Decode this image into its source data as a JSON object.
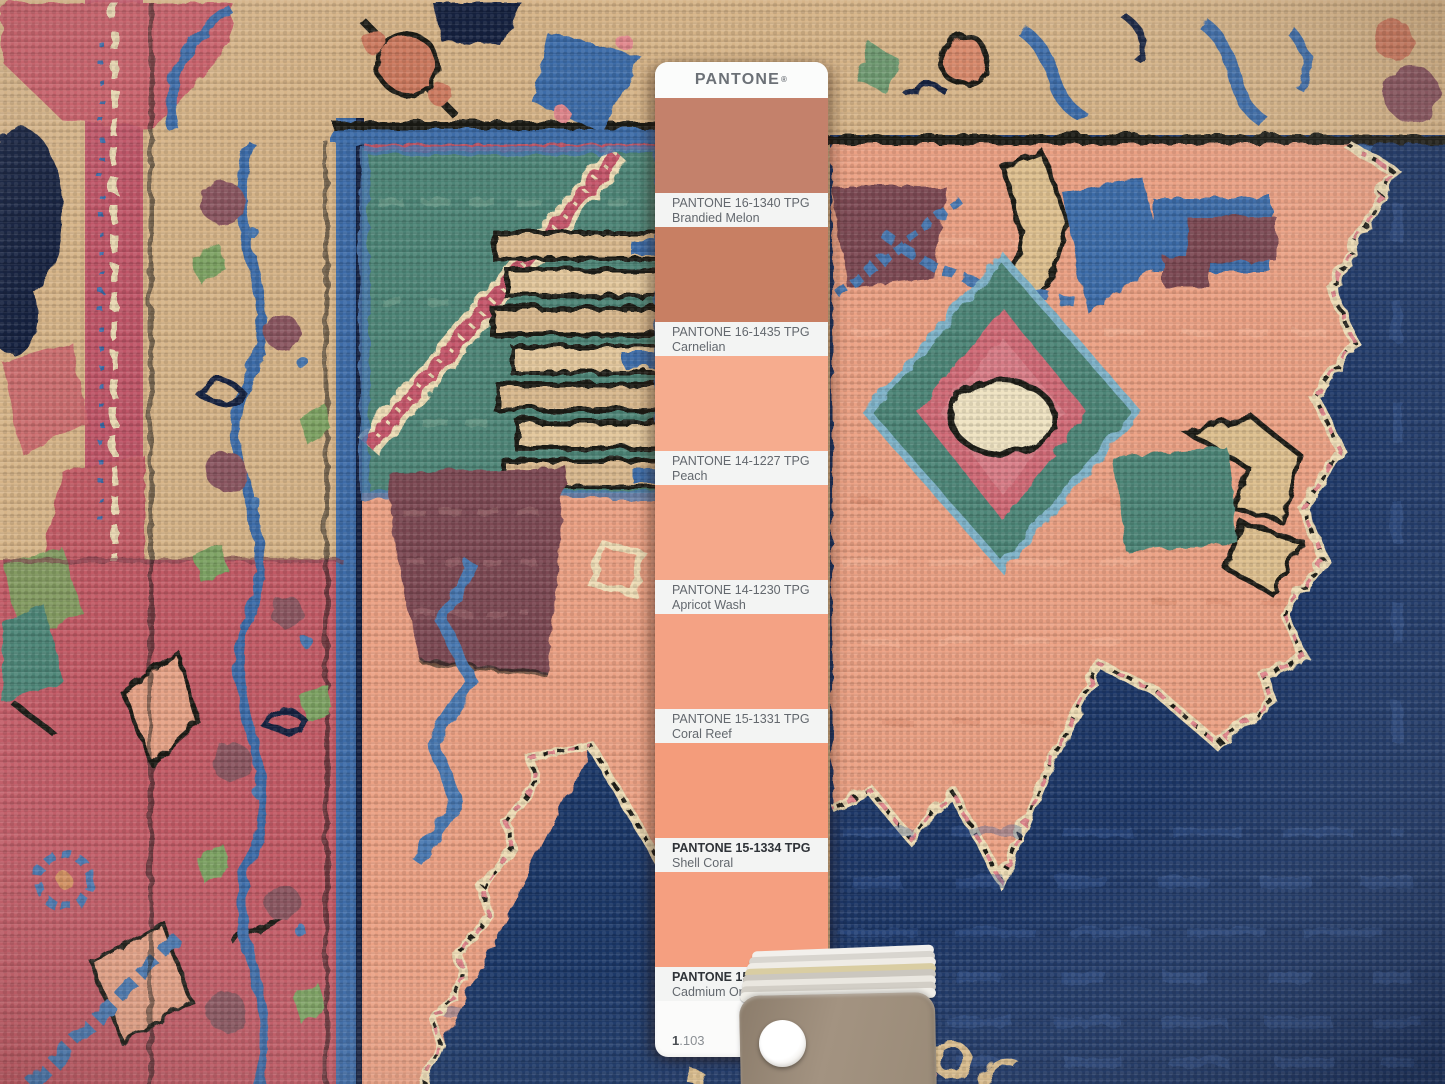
{
  "pantone": {
    "brand": "PANTONE",
    "registered_mark": "®",
    "chips": [
      {
        "code": "PANTONE 16-1340 TPG",
        "name": "Brandied Melon",
        "color": "#c4816b"
      },
      {
        "code": "PANTONE 16-1435 TPG",
        "name": "Carnelian",
        "color": "#c87f63"
      },
      {
        "code": "PANTONE 14-1227 TPG",
        "name": "Peach",
        "color": "#f6ac8e"
      },
      {
        "code": "PANTONE 14-1230 TPG",
        "name": "Apricot Wash",
        "color": "#f5a88a"
      },
      {
        "code": "PANTONE 15-1331 TPG",
        "name": "Coral Reef",
        "color": "#f4a284"
      },
      {
        "code": "PANTONE 15-1334 TPG",
        "name": "Shell Coral",
        "color": "#f49c7b"
      },
      {
        "code": "PANTONE 15-1340 TPG",
        "name": "Cadmium Orange",
        "color": "#f59f80"
      }
    ],
    "page_prefix": "1",
    "page_suffix": ".103"
  },
  "photo": {
    "rug_palette": {
      "tan_field": "#d6b488",
      "tan_light": "#e3c79c",
      "navy_field": "#1d3767",
      "navy_dark": "#14203f",
      "blue_motif": "#3e6ca8",
      "teal_field": "#4e8577",
      "salmon_medallion": "#eba184",
      "rose_field": "#c25b66",
      "red_band": "#bf5668",
      "maroon_motif": "#7c4a52",
      "cream_outline": "#eeddb6",
      "black_outline": "#1c1b18",
      "pink_accent": "#e0868c",
      "green_leaf": "#7da263"
    },
    "fan_deck_top_card_color": "#9a8b78",
    "fan_deck_grommet_color": "#ffffff"
  }
}
